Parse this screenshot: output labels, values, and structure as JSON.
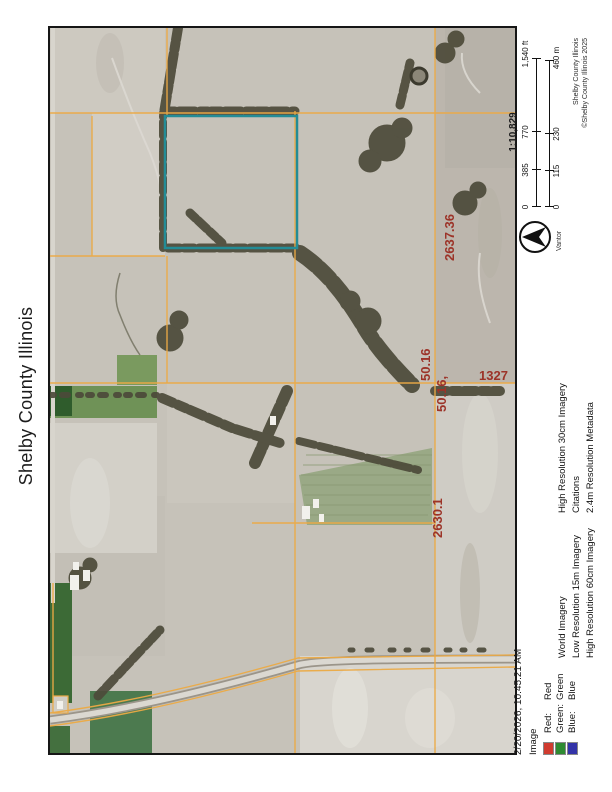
{
  "page": {
    "title": "Shelby County Illinois"
  },
  "footer": {
    "datetime": "2/20/2026, 10:45:21 AM"
  },
  "legend": {
    "layer_title": "Image",
    "bands": [
      {
        "label": "Red:",
        "value": "Red",
        "color": "#d03b2f"
      },
      {
        "label": "Green:",
        "value": "Green",
        "color": "#2e8b32"
      },
      {
        "label": "Blue:",
        "value": "Blue",
        "color": "#3333a8"
      }
    ],
    "col2": [
      "World Imagery",
      "Low Resolution 15m Imagery",
      "High Resolution 60cm Imagery"
    ],
    "col3": [
      "High Resolution 30cm Imagery",
      "Citations",
      "2.4m Resolution Metadata"
    ]
  },
  "scalebar": {
    "ratio": "1:10,829",
    "ft": [
      "0",
      "385",
      "770",
      "1,540 ft"
    ],
    "m": [
      "0",
      "115",
      "230",
      "460 m"
    ]
  },
  "north": {
    "label": "Vantor"
  },
  "credits": {
    "line1": "Shelby County Illinois",
    "line2": "©Shelby County Illinois 2025"
  },
  "map": {
    "labels": [
      {
        "text": "2637.36"
      },
      {
        "text": "50.16"
      },
      {
        "text": "50.16,"
      },
      {
        "text": "1327"
      },
      {
        "text": "2630.1"
      }
    ],
    "colors": {
      "parcel_line": "#ecaa45",
      "highlight": "#238c96",
      "label": "#9c3328",
      "woodland": "#4c4a39",
      "field_base": "#c6c2b9"
    }
  }
}
